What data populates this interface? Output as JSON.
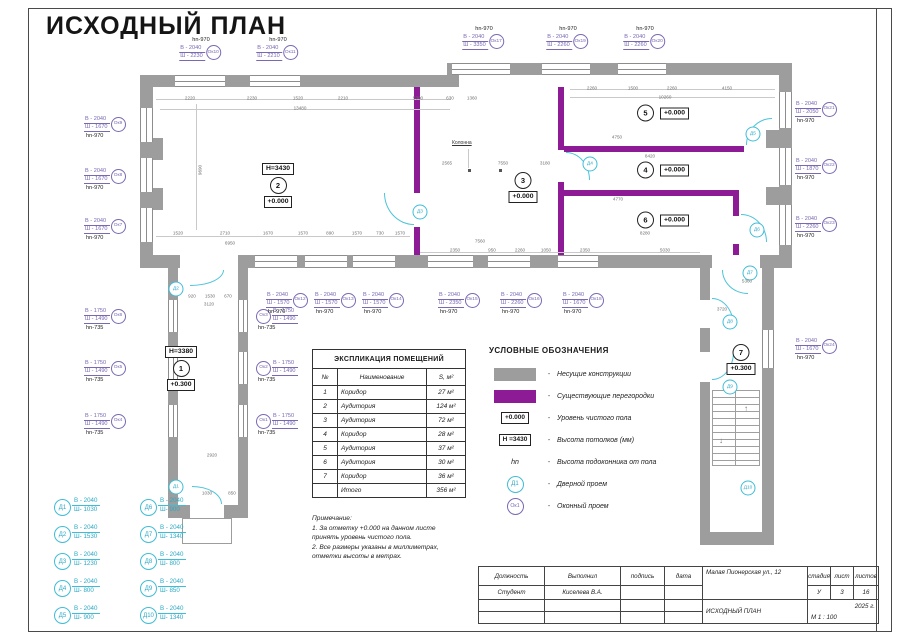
{
  "page": {
    "title": "ИСХОДНЫЙ ПЛАН"
  },
  "colors": {
    "wall": "#9d9d9d",
    "partition": "#8e1b96",
    "window_label": "#7a68b4",
    "door": "#3fbdd6"
  },
  "plan": {
    "column_label": "Колонна",
    "rooms": [
      {
        "num": "1",
        "h": "Н=3380",
        "elev": "+0.300",
        "x": 181,
        "y": 346,
        "layout": "v"
      },
      {
        "num": "2",
        "h": "Н=3430",
        "elev": "+0.000",
        "x": 278,
        "y": 163,
        "layout": "v"
      },
      {
        "num": "3",
        "elev": "+0.000",
        "x": 523,
        "y": 172,
        "layout": "v"
      },
      {
        "num": "5",
        "elev": "+0.000",
        "x": 663,
        "y": 113,
        "layout": "h"
      },
      {
        "num": "4",
        "elev": "+0.000",
        "x": 663,
        "y": 170,
        "layout": "h"
      },
      {
        "num": "6",
        "elev": "+0.000",
        "x": 663,
        "y": 220,
        "layout": "h"
      },
      {
        "num": "7",
        "elev": "+0.300",
        "x": 741,
        "y": 344,
        "layout": "v"
      }
    ],
    "windows": [
      {
        "id": "Ок10",
        "v": "В - 2040",
        "sh": "Ш - 2230",
        "hn": "hn-970",
        "mode": "top",
        "x": 200,
        "y": 37
      },
      {
        "id": "Ок11",
        "v": "В - 2040",
        "sh": "Ш - 2210",
        "hn": "hn-970",
        "mode": "top",
        "x": 277,
        "y": 37
      },
      {
        "id": "Ок17",
        "v": "В - 2040",
        "sh": "Ш - 3350",
        "hn": "hn-970",
        "mode": "top",
        "x": 483,
        "y": 26
      },
      {
        "id": "Ок19",
        "v": "В - 2040",
        "sh": "Ш - 2260",
        "hn": "hn-970",
        "mode": "top",
        "x": 567,
        "y": 26
      },
      {
        "id": "Ок20",
        "v": "В - 2040",
        "sh": "Ш - 2260",
        "hn": "hn-970",
        "mode": "top",
        "x": 644,
        "y": 26
      },
      {
        "id": "Ок9",
        "v": "В - 2040",
        "sh": "Ш - 1670",
        "hn": "hn-970",
        "mode": "side",
        "x": 84,
        "y": 116
      },
      {
        "id": "Ок8",
        "v": "В - 2040",
        "sh": "Ш - 1670",
        "hn": "hn-970",
        "mode": "side",
        "x": 84,
        "y": 168
      },
      {
        "id": "Ок7",
        "v": "В - 2040",
        "sh": "Ш - 1670",
        "hn": "hn-970",
        "mode": "side",
        "x": 84,
        "y": 218
      },
      {
        "id": "Ок6",
        "v": "В - 1750",
        "sh": "Ш - 1490",
        "hn": "hn-735",
        "mode": "side",
        "x": 84,
        "y": 308
      },
      {
        "id": "Ок5",
        "v": "В - 1750",
        "sh": "Ш - 1490",
        "hn": "hn-735",
        "mode": "side",
        "x": 84,
        "y": 360
      },
      {
        "id": "Ок4",
        "v": "В - 1750",
        "sh": "Ш - 1490",
        "hn": "hn-735",
        "mode": "side",
        "x": 84,
        "y": 413
      },
      {
        "id": "Ок3",
        "v": "В - 1750",
        "sh": "Ш - 1490",
        "hn": "hn-735",
        "mode": "circleleft",
        "x": 256,
        "y": 308
      },
      {
        "id": "Ок2",
        "v": "В - 1750",
        "sh": "Ш - 1490",
        "hn": "hn-735",
        "mode": "circleleft",
        "x": 256,
        "y": 360
      },
      {
        "id": "Ок1",
        "v": "В - 1750",
        "sh": "Ш - 1490",
        "hn": "hn-735",
        "mode": "circleleft",
        "x": 256,
        "y": 413
      },
      {
        "id": "Ок12",
        "v": "В - 2040",
        "sh": "Ш - 1570",
        "hn": "hn-970",
        "mode": "side",
        "x": 266,
        "y": 292
      },
      {
        "id": "Ок13",
        "v": "В - 2040",
        "sh": "Ш - 1570",
        "hn": "hn-970",
        "mode": "side",
        "x": 314,
        "y": 292
      },
      {
        "id": "Ок14",
        "v": "В - 2040",
        "sh": "Ш - 1570",
        "hn": "hn-970",
        "mode": "side",
        "x": 362,
        "y": 292
      },
      {
        "id": "Ок15",
        "v": "В - 2040",
        "sh": "Ш - 2350",
        "hn": "hn-970",
        "mode": "side",
        "x": 438,
        "y": 292
      },
      {
        "id": "Ок16",
        "v": "В - 2040",
        "sh": "Ш - 2260",
        "hn": "hn-970",
        "mode": "side",
        "x": 500,
        "y": 292
      },
      {
        "id": "Ок18",
        "v": "В - 2040",
        "sh": "Ш - 1670",
        "hn": "hn-970",
        "mode": "side",
        "x": 562,
        "y": 292
      },
      {
        "id": "Ок21",
        "v": "В - 2040",
        "sh": "Ш - 2050",
        "hn": "hn-970",
        "mode": "side",
        "x": 795,
        "y": 101
      },
      {
        "id": "Ок22",
        "v": "В - 2040",
        "sh": "Ш - 1870",
        "hn": "hn-970",
        "mode": "side",
        "x": 795,
        "y": 158
      },
      {
        "id": "Ок23",
        "v": "В - 2040",
        "sh": "Ш - 2260",
        "hn": "hn-970",
        "mode": "side",
        "x": 795,
        "y": 216
      },
      {
        "id": "Ок24",
        "v": "В - 2040",
        "sh": "Ш - 1670",
        "hn": "hn-970",
        "mode": "side",
        "x": 795,
        "y": 338
      }
    ],
    "doors": [
      {
        "id": "Д1",
        "x": 176,
        "y": 487
      },
      {
        "id": "Д2",
        "x": 176,
        "y": 289
      },
      {
        "id": "Д3",
        "x": 420,
        "y": 212
      },
      {
        "id": "Д4",
        "x": 590,
        "y": 164
      },
      {
        "id": "Д5",
        "x": 753,
        "y": 134
      },
      {
        "id": "Д6",
        "x": 757,
        "y": 230
      },
      {
        "id": "Д7",
        "x": 750,
        "y": 273
      },
      {
        "id": "Д8",
        "x": 730,
        "y": 322
      },
      {
        "id": "Д9",
        "x": 730,
        "y": 387
      },
      {
        "id": "Д10",
        "x": 748,
        "y": 488
      }
    ],
    "dims": [
      {
        "t": "2220",
        "x": 190,
        "y": 98
      },
      {
        "t": "2230",
        "x": 252,
        "y": 98
      },
      {
        "t": "1520",
        "x": 298,
        "y": 98
      },
      {
        "t": "2210",
        "x": 343,
        "y": 98
      },
      {
        "t": "5300",
        "x": 418,
        "y": 98
      },
      {
        "t": "630",
        "x": 450,
        "y": 98
      },
      {
        "t": "1360",
        "x": 472,
        "y": 98
      },
      {
        "t": "13480",
        "x": 300,
        "y": 108
      },
      {
        "t": "2260",
        "x": 592,
        "y": 88
      },
      {
        "t": "1500",
        "x": 633,
        "y": 88
      },
      {
        "t": "2260",
        "x": 672,
        "y": 88
      },
      {
        "t": "4150",
        "x": 727,
        "y": 88
      },
      {
        "t": "10260",
        "x": 665,
        "y": 97
      },
      {
        "t": "1520",
        "x": 178,
        "y": 233
      },
      {
        "t": "2710",
        "x": 225,
        "y": 233
      },
      {
        "t": "1670",
        "x": 268,
        "y": 233
      },
      {
        "t": "1570",
        "x": 303,
        "y": 233
      },
      {
        "t": "890",
        "x": 330,
        "y": 233
      },
      {
        "t": "1570",
        "x": 357,
        "y": 233
      },
      {
        "t": "730",
        "x": 380,
        "y": 233
      },
      {
        "t": "1570",
        "x": 400,
        "y": 233
      },
      {
        "t": "6950",
        "x": 230,
        "y": 243
      },
      {
        "t": "9690",
        "x": 200,
        "y": 170,
        "r": true
      },
      {
        "t": "2565",
        "x": 447,
        "y": 163
      },
      {
        "t": "7550",
        "x": 503,
        "y": 163
      },
      {
        "t": "3180",
        "x": 545,
        "y": 163
      },
      {
        "t": "2350",
        "x": 455,
        "y": 250
      },
      {
        "t": "950",
        "x": 492,
        "y": 250
      },
      {
        "t": "2260",
        "x": 520,
        "y": 250
      },
      {
        "t": "1050",
        "x": 546,
        "y": 250
      },
      {
        "t": "2350",
        "x": 585,
        "y": 250
      },
      {
        "t": "5030",
        "x": 665,
        "y": 250
      },
      {
        "t": "7560",
        "x": 480,
        "y": 241
      },
      {
        "t": "4750",
        "x": 617,
        "y": 137
      },
      {
        "t": "8420",
        "x": 650,
        "y": 156
      },
      {
        "t": "4770",
        "x": 618,
        "y": 199
      },
      {
        "t": "8280",
        "x": 645,
        "y": 233
      },
      {
        "t": "920",
        "x": 192,
        "y": 296
      },
      {
        "t": "1530",
        "x": 210,
        "y": 296
      },
      {
        "t": "670",
        "x": 228,
        "y": 296
      },
      {
        "t": "3120",
        "x": 209,
        "y": 304
      },
      {
        "t": "2920",
        "x": 212,
        "y": 455
      },
      {
        "t": "1030",
        "x": 207,
        "y": 493
      },
      {
        "t": "850",
        "x": 232,
        "y": 493
      },
      {
        "t": "5360",
        "x": 747,
        "y": 281
      },
      {
        "t": "3720",
        "x": 722,
        "y": 309
      }
    ]
  },
  "legend": {
    "title": "УСЛОВНЫЕ ОБОЗНАЧЕНИЯ",
    "items": [
      {
        "kind": "wall",
        "symbol": "",
        "label": "Несущие конструкции"
      },
      {
        "kind": "partition",
        "symbol": "",
        "label": "Существующие перегородки"
      },
      {
        "kind": "box",
        "symbol": "+0.000",
        "label": "Уровень чистого пола"
      },
      {
        "kind": "box",
        "symbol": "Н =3430",
        "label": "Высота потолков (мм)"
      },
      {
        "kind": "hn",
        "symbol": "hn",
        "label": "Высота подоконника от пола"
      },
      {
        "kind": "door",
        "symbol": "Д1",
        "label": "Дверной проем"
      },
      {
        "kind": "window",
        "symbol": "Ок1",
        "label": "Оконный проем"
      }
    ]
  },
  "schedule": {
    "title": "ЭКСПЛИКАЦИЯ ПОМЕЩЕНИЙ",
    "headers": [
      "№",
      "Наименование",
      "S, м²"
    ],
    "rows": [
      [
        "1",
        "Коридор",
        "27 м²"
      ],
      [
        "2",
        "Аудитория",
        "124 м²"
      ],
      [
        "3",
        "Аудитория",
        "72 м²"
      ],
      [
        "4",
        "Коридор",
        "28 м²"
      ],
      [
        "5",
        "Аудитория",
        "37 м²"
      ],
      [
        "6",
        "Аудитория",
        "30 м²"
      ],
      [
        "7",
        "Коридор",
        "36 м²"
      ],
      [
        "",
        "Итого",
        "356 м²"
      ]
    ]
  },
  "door_specs": [
    {
      "id": "Д1",
      "v": "В - 2040",
      "sh": "Ш- 1030"
    },
    {
      "id": "Д2",
      "v": "В - 2040",
      "sh": "Ш- 1530"
    },
    {
      "id": "Д3",
      "v": "В - 2040",
      "sh": "Ш- 1230"
    },
    {
      "id": "Д4",
      "v": "В - 2040",
      "sh": "Ш- 800"
    },
    {
      "id": "Д5",
      "v": "В - 2040",
      "sh": "Ш- 900"
    },
    {
      "id": "Д6",
      "v": "В - 2040",
      "sh": "Ш- 900"
    },
    {
      "id": "Д7",
      "v": "В - 2040",
      "sh": "Ш- 1340"
    },
    {
      "id": "Д8",
      "v": "В - 2040",
      "sh": "Ш- 800"
    },
    {
      "id": "Д9",
      "v": "В - 2040",
      "sh": "Ш- 850"
    },
    {
      "id": "Д10",
      "v": "В - 2040",
      "sh": "Ш- 1340"
    }
  ],
  "notes": {
    "title": "Примечание:",
    "lines": [
      "1. За отметку +0.000 на данном листе",
      "принять уровень чистого пола.",
      "2. Все размеры указаны в миллиметрах,",
      "отметки высоты в метрах."
    ]
  },
  "titleblock": {
    "headers": {
      "role": "Должность",
      "author": "Выполнил",
      "sign": "подпись",
      "date": "дата",
      "stage": "стадия",
      "sheet": "лист",
      "sheets": "листов"
    },
    "values": {
      "role": "Студент",
      "author": "Киселева В.А.",
      "stage": "У",
      "sheet": "3",
      "sheets": "16"
    },
    "address": "Малая Пионерская ул., 12",
    "doc": "ИСХОДНЫЙ ПЛАН",
    "year": "2025 г.",
    "scale": "М 1 : 100"
  }
}
